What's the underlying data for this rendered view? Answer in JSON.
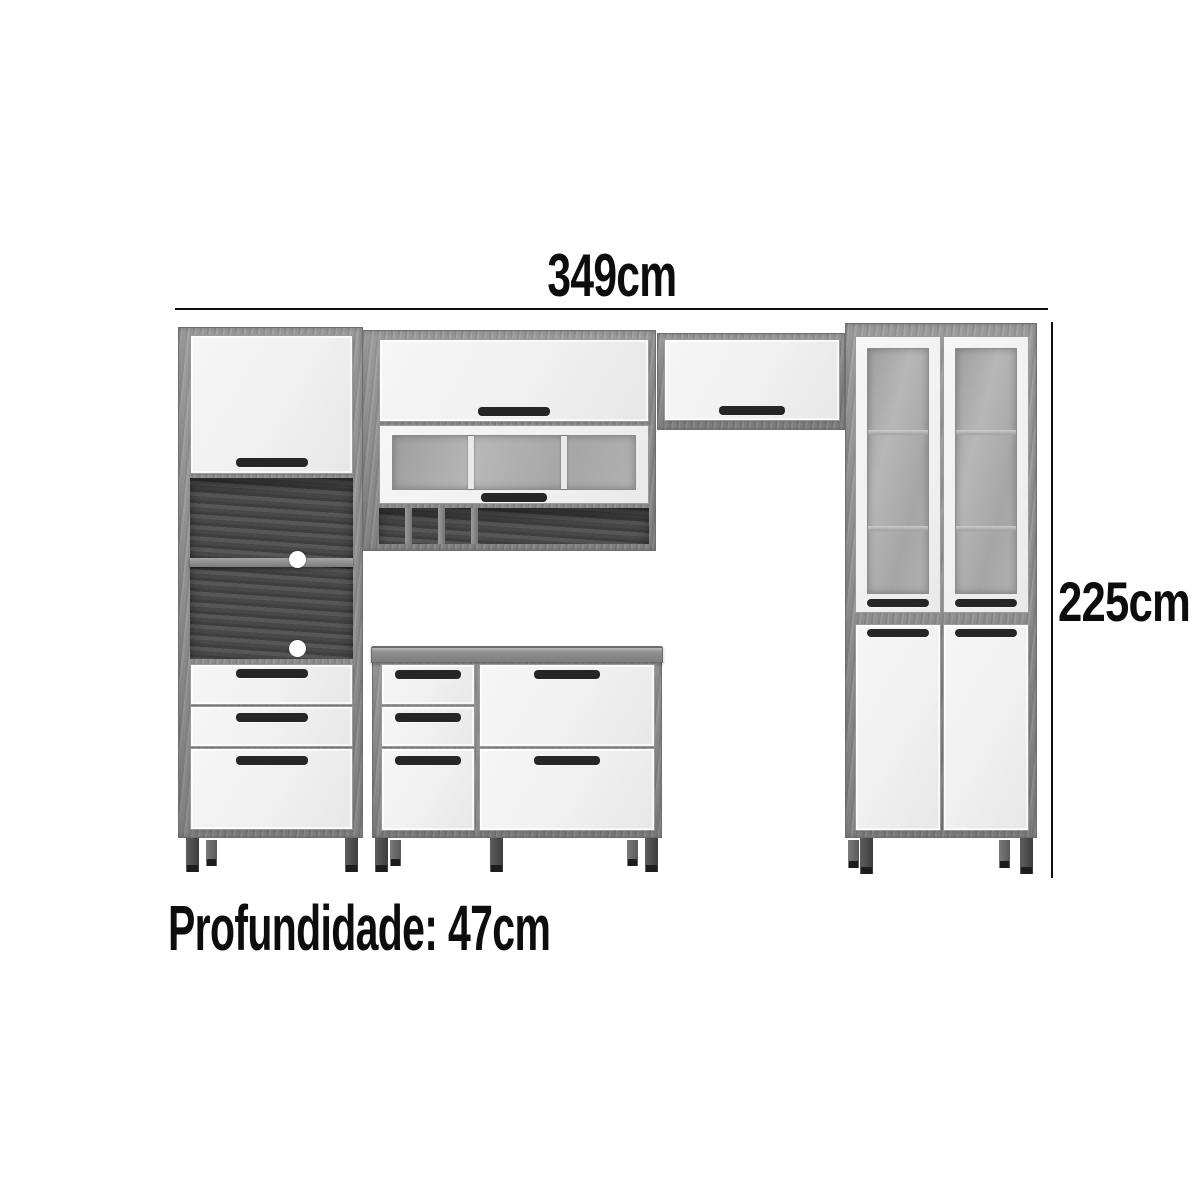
{
  "diagram": {
    "width_label": "349cm",
    "height_label": "225cm",
    "depth_label": "Profundidade: 47cm"
  },
  "colors": {
    "background": "#ffffff",
    "dimension_text": "#0d0d0d",
    "dimension_line": "#111111",
    "wood_frame": "#949494",
    "wood_dark_edge": "#6e6e6e",
    "door_white": "#f0f0f0",
    "glass_frosted": "#a6a6a6",
    "niche_interior": "#484848",
    "handle": "#262626",
    "leg_foot": "#1d1d1d"
  }
}
